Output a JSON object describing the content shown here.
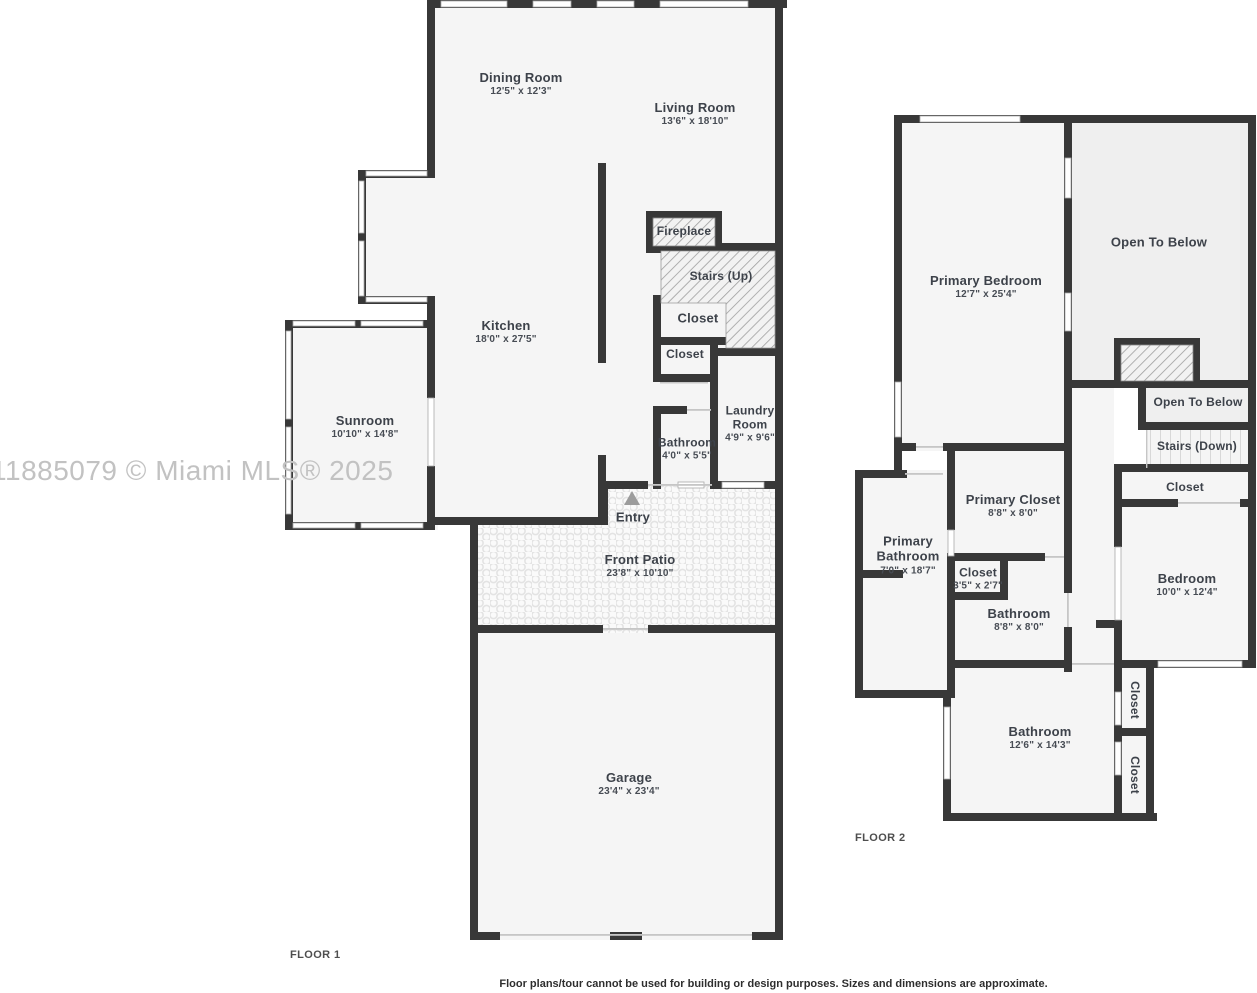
{
  "watermark": "11885079 © Miami MLS® 2025",
  "disclaimer": "Floor plans/tour cannot be used for building or design purposes. Sizes and dimensions are approximate.",
  "colors": {
    "wall": "#383838",
    "room_fill": "#f5f5f5",
    "open_to_below_fill": "#efefef",
    "label_text": "#3d424a",
    "watermark_text": "#c2c2c2"
  },
  "floor1": {
    "label": "FLOOR 1",
    "rooms": {
      "dining_room": {
        "name": "Dining Room",
        "dims": "12'5\" x 12'3\""
      },
      "living_room": {
        "name": "Living Room",
        "dims": "13'6\" x 18'10\""
      },
      "kitchen": {
        "name": "Kitchen",
        "dims": "18'0\" x 27'5\""
      },
      "sunroom": {
        "name": "Sunroom",
        "dims": "10'10\" x 14'8\""
      },
      "fireplace": {
        "name": "Fireplace"
      },
      "stairs_up": {
        "name": "Stairs (Up)"
      },
      "closet_a": {
        "name": "Closet"
      },
      "closet_b": {
        "name": "Closet"
      },
      "bathroom": {
        "name": "Bathroom",
        "dims": "4'0\" x 5'5\""
      },
      "laundry_room": {
        "name": "Laundry Room",
        "dims": "4'9\" x 9'6\""
      },
      "entry": {
        "name": "Entry"
      },
      "front_patio": {
        "name": "Front Patio",
        "dims": "23'8\" x 10'10\""
      },
      "garage": {
        "name": "Garage",
        "dims": "23'4\" x 23'4\""
      }
    }
  },
  "floor2": {
    "label": "FLOOR 2",
    "rooms": {
      "primary_bedroom": {
        "name": "Primary Bedroom",
        "dims": "12'7\" x 25'4\""
      },
      "open_to_below_large": {
        "name": "Open To Below"
      },
      "open_to_below_small": {
        "name": "Open To Below"
      },
      "stairs_down": {
        "name": "Stairs (Down)"
      },
      "closet_stairs": {
        "name": "Closet"
      },
      "primary_closet": {
        "name": "Primary Closet",
        "dims": "8'8\" x 8'0\""
      },
      "primary_bathroom": {
        "name": "Primary Bathroom",
        "dims": "7'0\" x 18'7\""
      },
      "closet_small": {
        "name": "Closet",
        "dims": "3'5\" x 2'7\""
      },
      "bathroom_upper": {
        "name": "Bathroom",
        "dims": "8'8\" x 8'0\""
      },
      "bedroom": {
        "name": "Bedroom",
        "dims": "10'0\" x 12'4\""
      },
      "bathroom_large": {
        "name": "Bathroom",
        "dims": "12'6\" x 14'3\""
      },
      "closet_vert_top": {
        "name": "Closet"
      },
      "closet_vert_bottom": {
        "name": "Closet"
      }
    }
  }
}
